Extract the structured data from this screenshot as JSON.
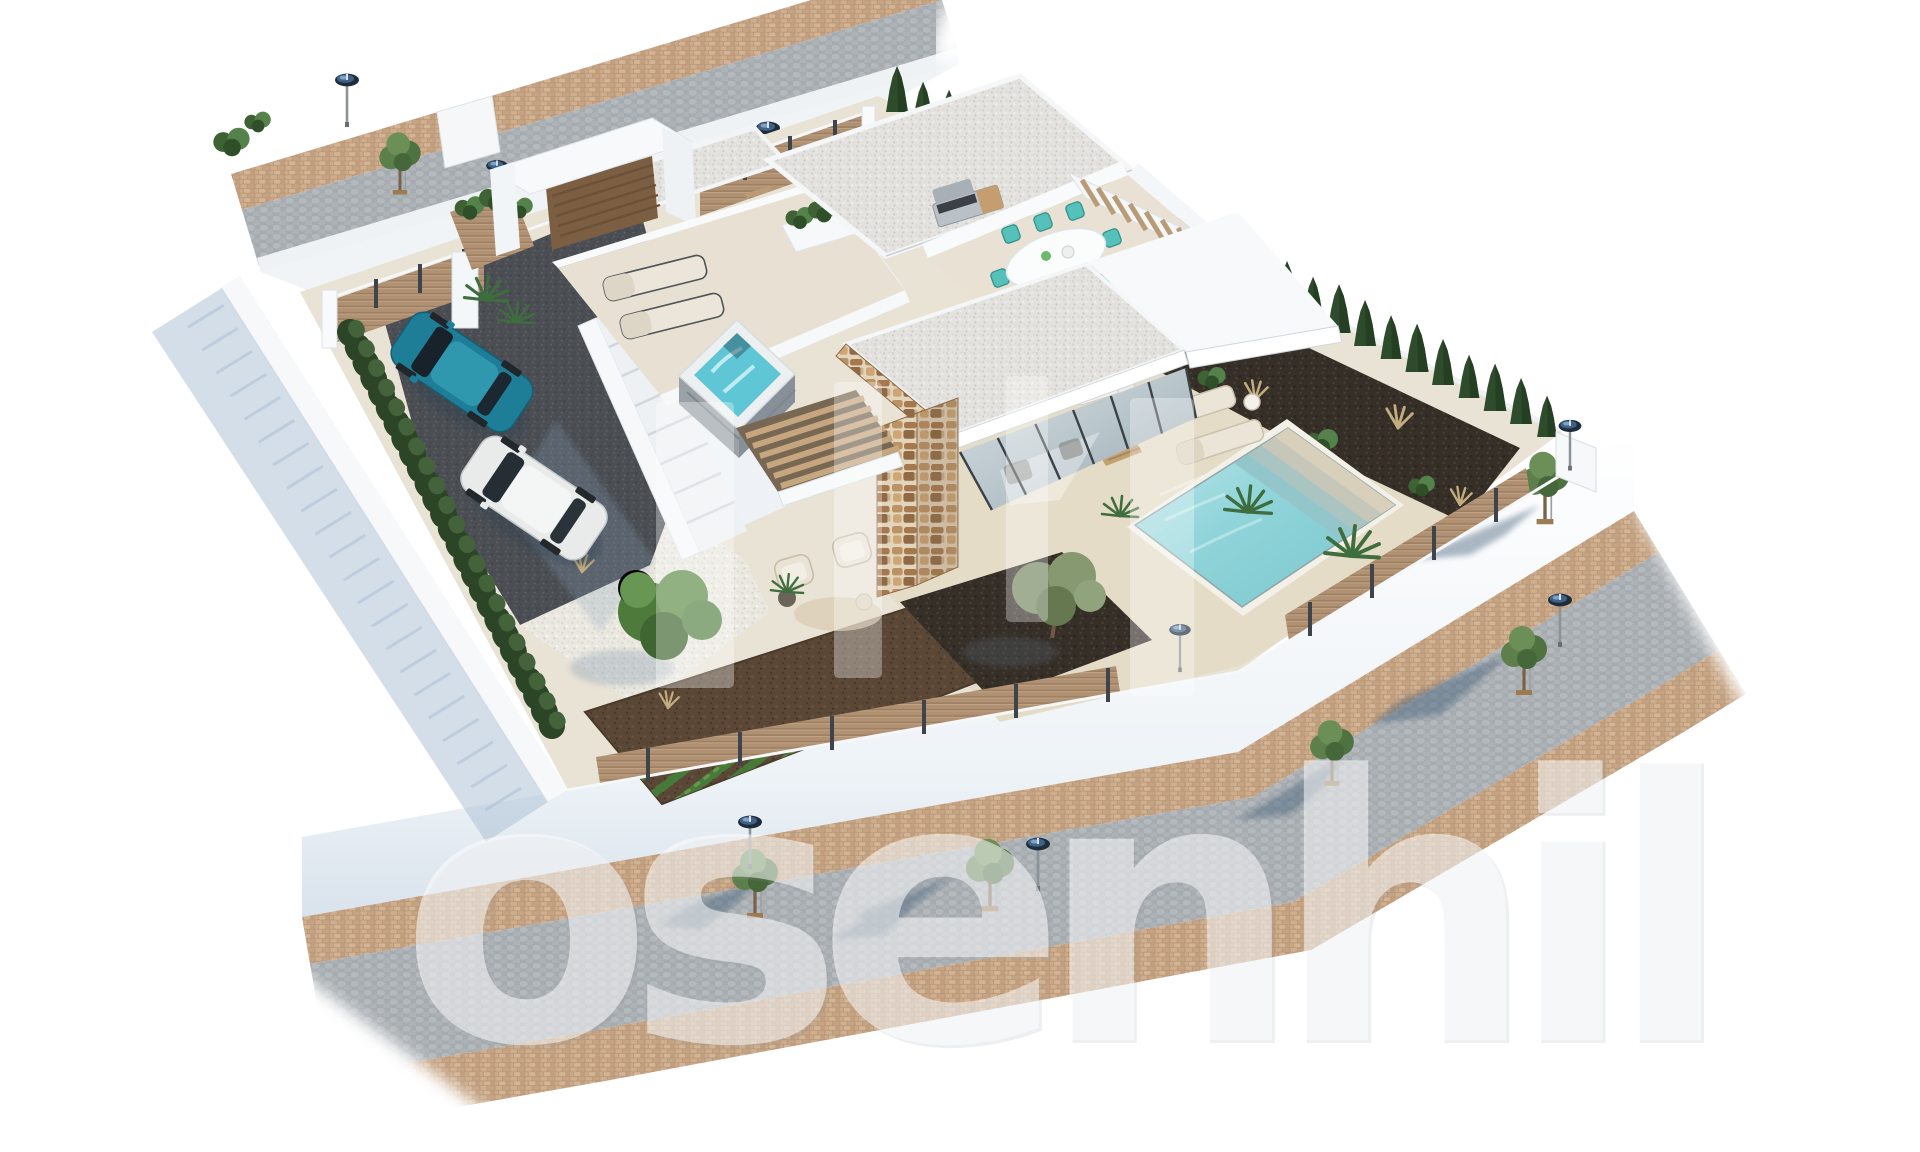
{
  "meta": {
    "title": "Aerial 3D architectural render - modern white villa with pool",
    "style": "photoreal archviz, aerial isometric view on white background",
    "background": "#ffffff"
  },
  "watermark": {
    "text": "osenhil",
    "logo_bar_count": 4,
    "color": "#ffffff"
  },
  "palette": {
    "white_wall": "#f3f6f8",
    "cream_deck": "#e9e3d6",
    "pool_water": "#86d0d6",
    "teal_furniture": "#56c1ba",
    "wood_fence": "#b09173",
    "cobblestone": "#a6abb0",
    "paver": "#c3a282",
    "cypress": "#2f4f2c",
    "mulch": "#362f28",
    "soil": "#5a4735",
    "dark_gravel": "#4b4f54",
    "shadow_blue": "#a9bdd3",
    "stone_clad": "#b08c5f",
    "car_teal": "#1f7e97",
    "car_white": "#e9ebea"
  },
  "scene": {
    "streets": [
      {
        "name": "upper street",
        "surface": "grey cobblestone road with brown paver sidewalk",
        "lamps": 2,
        "trees": 1
      },
      {
        "name": "lower street",
        "surface": "grey cobblestone road between brown paver sidewalks",
        "lamps": 3,
        "trees": 5,
        "corner_pillar_lamp": 1
      }
    ],
    "plot": {
      "shape": "walled corner plot",
      "boundary": "white walls with wood-slat fence panels and dark posts",
      "hedge": "clipped green hedge along left wall",
      "cypresses": 26
    },
    "entrance": {
      "gate": "white portal frame",
      "door": "wooden slat door",
      "driveway": "dark gravel",
      "parked_cars": [
        "teal hatchback",
        "white SUV"
      ]
    },
    "villa": {
      "storeys": 2,
      "style": "modern white cubic volumes",
      "roofs": [
        "white gravel flat roofs",
        "plain white slab roof"
      ],
      "stone_feature_wall": true,
      "glass_walls": "full-height dark-framed sliding glass",
      "pergola": "wooden slat pergola",
      "exterior_stair": "side staircase to roof terrace"
    },
    "roof_terrace": {
      "sun_loungers": 2,
      "hot_tub": "square spa with aqua water",
      "planter": "white planter with shrubs"
    },
    "dining_terrace": {
      "table": "white oval dining table",
      "chairs": 8,
      "chair_color": "teal",
      "bbq": "stainless steel grill",
      "louvered_planters": 2
    },
    "lounge_terrace": {
      "armchairs": 2,
      "plant_pot": 1,
      "round_rug": 1
    },
    "pool_area": {
      "pool": "rectangular with 4 roman steps",
      "deck": "cream stone tiles",
      "loungers": 2,
      "side_table": 1,
      "sofa_set": 1,
      "wood_coffee_table": 1,
      "fan_palms": 2,
      "garden_lamp": 1
    },
    "garden": {
      "vegetable_rows": 11,
      "olive_tree": 1,
      "round_bush_tree": 1,
      "white_gravel_bed": true,
      "dark_mulch_bed": "ornamental grasses and shrubs"
    }
  }
}
